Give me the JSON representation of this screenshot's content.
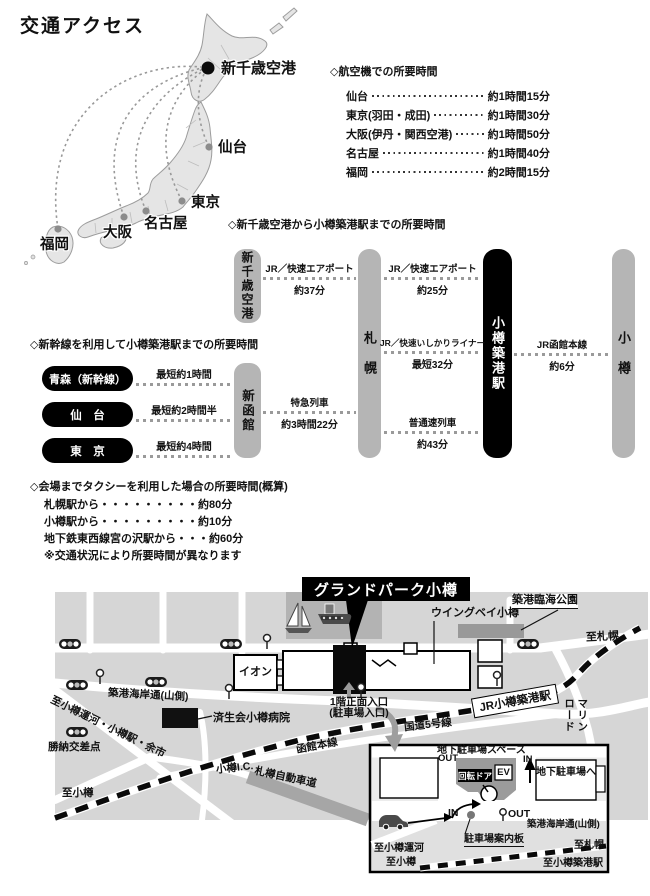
{
  "title": "交通アクセス",
  "japan_map": {
    "airport": "新千歳空港",
    "cities": [
      {
        "name": "仙台"
      },
      {
        "name": "東京"
      },
      {
        "name": "名古屋"
      },
      {
        "name": "大阪"
      },
      {
        "name": "福岡"
      }
    ]
  },
  "flight": {
    "title": "◇航空機での所要時間",
    "rows": [
      {
        "city": "仙台",
        "time": "約1時間15分"
      },
      {
        "city": "東京(羽田・成田)",
        "time": "約1時間30分"
      },
      {
        "city": "大阪(伊丹・関西空港)",
        "time": "約1時間50分"
      },
      {
        "city": "名古屋",
        "time": "約1時間40分"
      },
      {
        "city": "福岡",
        "time": "約2時間15分"
      }
    ]
  },
  "rail": {
    "title": "◇新千歳空港から小樽築港駅までの所要時間",
    "stations": {
      "chitose": "新千歳空港",
      "sapporo": "札　幌",
      "chikko": "小樽築港駅",
      "otaru": "小　樽",
      "hakodate": "新函館"
    },
    "routes": {
      "airport1": {
        "line": "JR／快速エアポート",
        "time": "約37分"
      },
      "airport2": {
        "line": "JR／快速エアポート",
        "time": "約25分"
      },
      "ishikari": {
        "line": "JR／快速いしかりライナー",
        "time": "最短32分"
      },
      "local": {
        "line": "普通速列車",
        "time": "約43分"
      },
      "ltd_exp": {
        "line": "特急列車",
        "time": "約3時間22分"
      },
      "hakodate_main": {
        "line": "JR函館本線",
        "time": "約6分"
      }
    }
  },
  "shinkansen": {
    "title": "◇新幹線を利用して小樽築港駅までの所要時間",
    "rows": [
      {
        "from": "青森（新幹線）",
        "time": "最短約1時間"
      },
      {
        "from": "仙　台",
        "time": "最短約2時間半"
      },
      {
        "from": "東　京",
        "time": "最短約4時間"
      }
    ]
  },
  "taxi": {
    "title": "◇会場までタクシーを利用した場合の所要時間(概算)",
    "lines": [
      "札幌駅から・・・・・・・・・約80分",
      "小樽駅から・・・・・・・・・約10分",
      "地下鉄東西線宮の沢駅から・・・約60分",
      "※交通状況により所要時間が異なります"
    ]
  },
  "map": {
    "banner": "グランドパーク小樽",
    "wingbay": "ウイングベイ小樽",
    "park": "築港臨海公園",
    "aeon": "イオン",
    "to_sapporo": "至札幌",
    "station": "JR小樽築港駅",
    "marine_road": "マリン\nロード",
    "kaigandori": "築港海岸通(山側)",
    "hospital": "済生会小樽病院",
    "canal_road": "至小樽運河・小樽駅・余市",
    "katsunai": "勝納交差点",
    "entrance1": "1階正面入口",
    "entrance2": "(駐車場入口)",
    "route5": "国道5号線",
    "hakodate_line": "函館本線",
    "otaru_ic": "小樽I.C.",
    "expressway": "札樽自動車道",
    "to_otaru": "至小樽"
  },
  "inset": {
    "title": "地下駐車場スペース",
    "out_top": "OUT",
    "in_top": "IN",
    "door": "回転ドア",
    "ev": "EV",
    "to_parking": "地下駐車場へ",
    "in_bottom": "IN",
    "out_bottom": "OUT",
    "sign": "駐車場案内板",
    "kaigandori": "築港海岸通(山側)",
    "to_canal": "至小樽運河",
    "to_otaru": "至小樽",
    "to_sapporo": "至札幌",
    "to_station": "至小樽築港駅"
  },
  "colors": {
    "pill_gray": "#b5b5b5",
    "pill_black": "#000000",
    "map_bg": "#d6d6d6",
    "harbor": "#b3b3b3",
    "park_block": "#999999",
    "road": "#ffffff",
    "highway": "#a6a6a6"
  }
}
